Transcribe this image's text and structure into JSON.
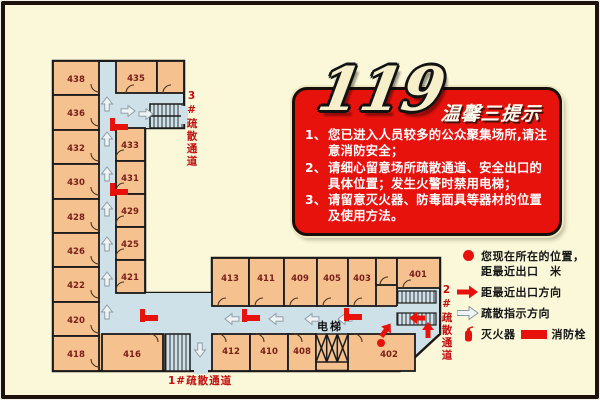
{
  "sign": {
    "number": "119",
    "title": "温馨三提示",
    "tips": [
      {
        "num": "1、",
        "text": "您已进入人员较多的公众聚集场所,请注意消防安全；"
      },
      {
        "num": "2、",
        "text": "请细心留意场所疏散通道、安全出口的具体位置；发生火警时禁用电梯；"
      },
      {
        "num": "3、",
        "text": "请留意灭火器、防毒面具等器材的位置及使用方法。"
      }
    ]
  },
  "legend": {
    "current_location": "您现在所在的位置，",
    "distance_line": "距最近出口　米",
    "nearest_exit_direction": "距最近出口方向",
    "evacuation_direction": "疏散指示方向",
    "extinguisher": "灭火器",
    "hydrant": "消防栓"
  },
  "labels": {
    "elevator": "电梯",
    "exit_route_1": "1#疏散通道",
    "exit_route_2": "2#疏散通道",
    "exit_route_3": "3#疏散通道"
  },
  "rooms": {
    "left": [
      "438",
      "436",
      "432",
      "430",
      "428",
      "426",
      "422",
      "420",
      "418"
    ],
    "mid": [
      "435",
      "433",
      "431",
      "429",
      "425",
      "421"
    ],
    "top": [
      "413",
      "411",
      "409",
      "405",
      "403",
      "401"
    ],
    "bottom": [
      "412",
      "410",
      "408",
      "402",
      "416"
    ]
  },
  "colors": {
    "background": "#faf8d9",
    "room_fill": "#f5c18f",
    "corridor_fill": "#cfe1e8",
    "wall": "#1a1a1a",
    "sign_red": "#e8120c",
    "marker_red": "#e8120c",
    "room_number": "#7a2018",
    "route_label_red": "#c40f0f"
  }
}
